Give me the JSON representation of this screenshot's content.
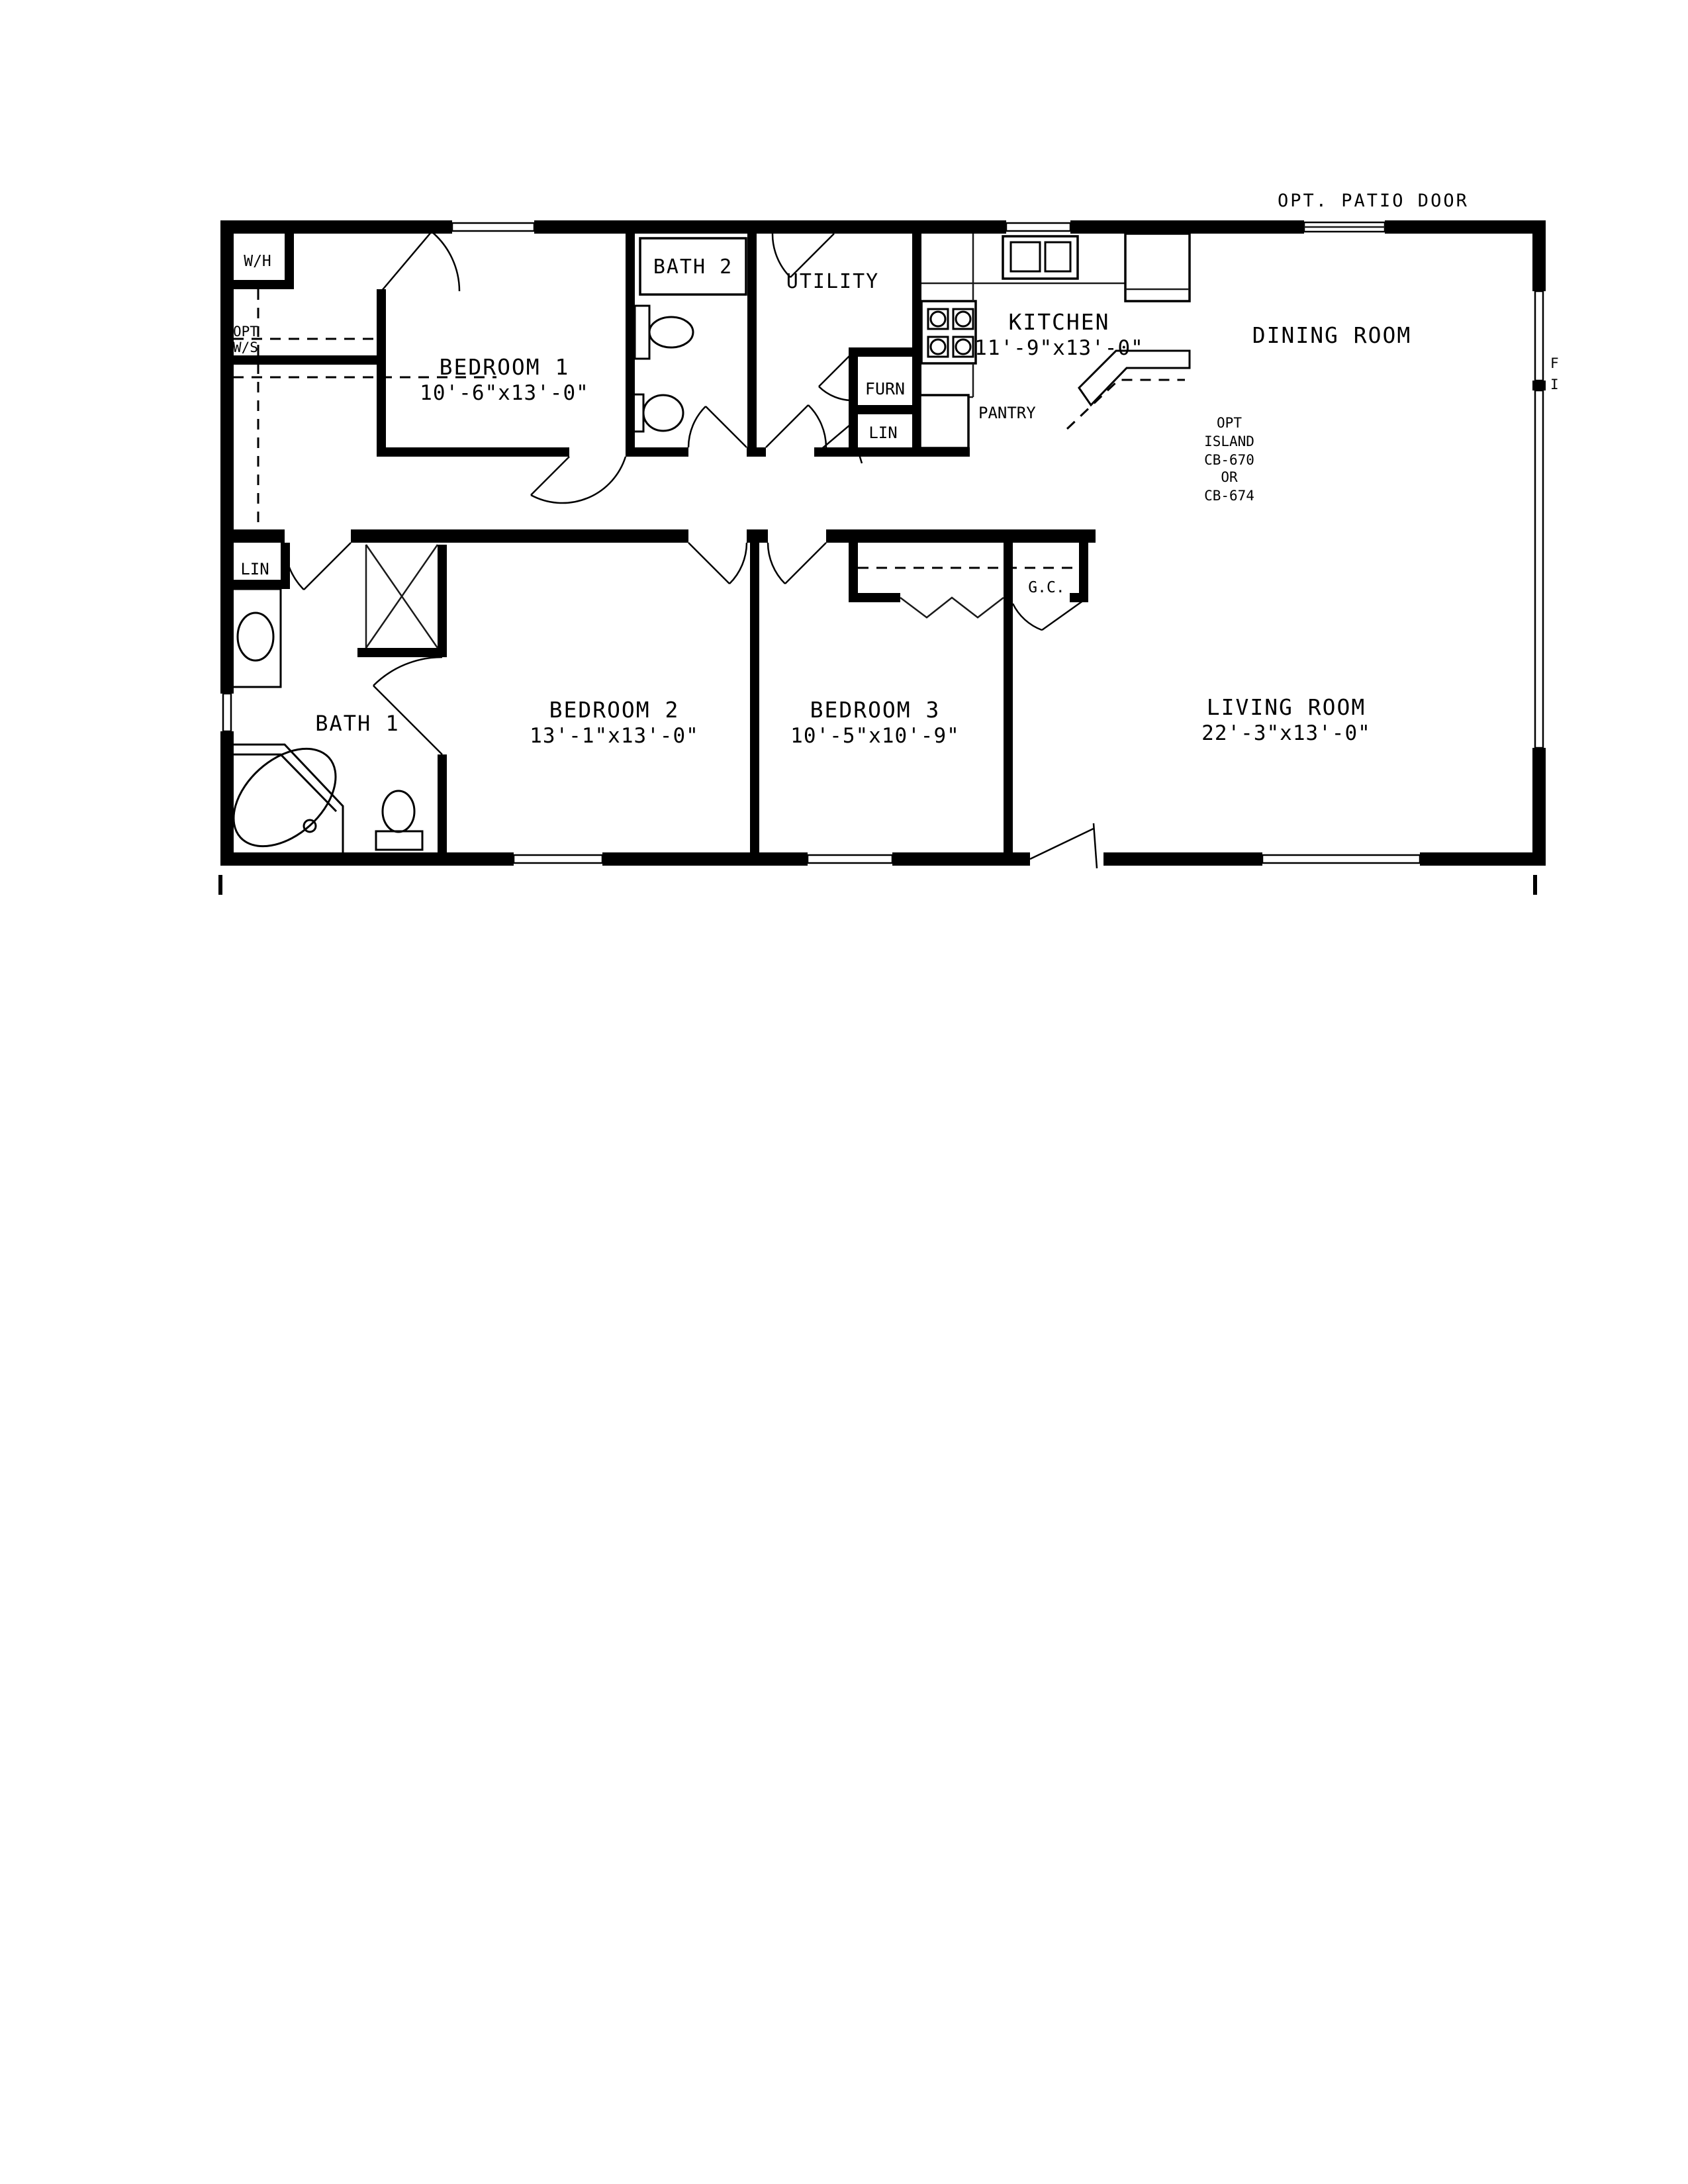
{
  "page": {
    "background": "#ffffff",
    "ink": "#000000"
  },
  "plan": {
    "annotations": {
      "patio_door": "OPT. PATIO DOOR",
      "edge_fragment_top": "F",
      "edge_fragment_bottom": "I"
    },
    "rooms": {
      "bedroom1": {
        "name": "BEDROOM 1",
        "dims": "10'-6\"x13'-0\""
      },
      "bath2": {
        "name": "BATH 2"
      },
      "utility": {
        "name": "UTILITY"
      },
      "kitchen": {
        "name": "KITCHEN",
        "dims": "11'-9\"x13'-0\""
      },
      "dining": {
        "name": "DINING ROOM"
      },
      "bath1": {
        "name": "BATH 1"
      },
      "bedroom2": {
        "name": "BEDROOM 2",
        "dims": "13'-1\"x13'-0\""
      },
      "bedroom3": {
        "name": "BEDROOM 3",
        "dims": "10'-5\"x10'-9\""
      },
      "living": {
        "name": "LIVING ROOM",
        "dims": "22'-3\"x13'-0\""
      }
    },
    "labels": {
      "water_heater": "W/H",
      "opt": "OPT",
      "ws": "W/S",
      "furnace": "FURN",
      "linen_hall": "LIN",
      "pantry": "PANTRY",
      "linen_bath1": "LIN",
      "guest_closet": "G.C.",
      "island_line1": "OPT",
      "island_line2": "ISLAND",
      "island_line3": "CB-670",
      "island_line4": "OR",
      "island_line5": "CB-674"
    }
  }
}
